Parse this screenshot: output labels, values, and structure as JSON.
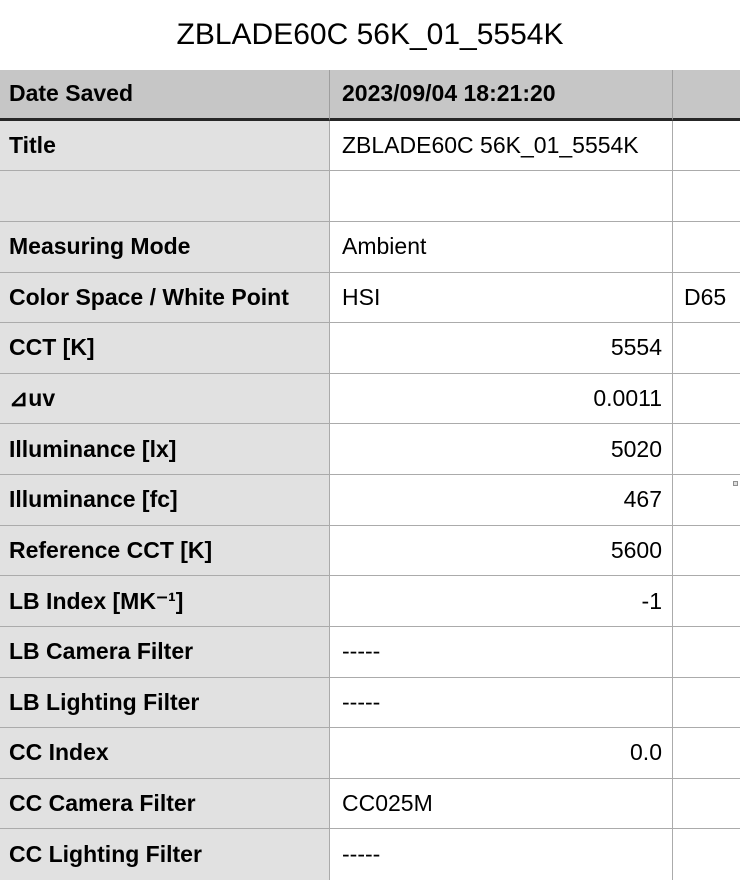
{
  "colors": {
    "background": "#FFFFFF",
    "header_row_bg": "#C6C6C6",
    "label_column_bg": "#E1E1E1",
    "grid_line": "#ABABAB",
    "header_bottom_border": "#262626",
    "text": "#000000"
  },
  "page": {
    "title": "ZBLADE60C 56K_01_5554K"
  },
  "table": {
    "header": {
      "label": "Date Saved",
      "value": "2023/09/04 18:21:20",
      "extra": ""
    },
    "rows": [
      {
        "label": "Title",
        "value": "ZBLADE60C 56K_01_5554K",
        "extra": ""
      },
      {
        "label": "",
        "value": "",
        "extra": ""
      },
      {
        "label": "Measuring Mode",
        "value": "Ambient",
        "extra": ""
      },
      {
        "label": "Color Space / White Point",
        "value": "HSI",
        "extra": "D65"
      },
      {
        "label": "CCT [K]",
        "value": "5554",
        "extra": ""
      },
      {
        "label": "⊿uv",
        "value": "0.0011",
        "extra": ""
      },
      {
        "label": "Illuminance [lx]",
        "value": "5020",
        "extra": ""
      },
      {
        "label": "Illuminance [fc]",
        "value": "467",
        "extra": ""
      },
      {
        "label": "Reference CCT [K]",
        "value": "5600",
        "extra": ""
      },
      {
        "label": "LB Index [MK⁻¹]",
        "value": "-1",
        "extra": ""
      },
      {
        "label": "LB Camera Filter",
        "value": "-----",
        "extra": ""
      },
      {
        "label": "LB Lighting Filter",
        "value": "-----",
        "extra": ""
      },
      {
        "label": "CC Index",
        "value": "0.0",
        "extra": ""
      },
      {
        "label": "CC Camera Filter",
        "value": "CC025M",
        "extra": ""
      },
      {
        "label": "CC Lighting Filter",
        "value": "-----",
        "extra": ""
      }
    ]
  }
}
